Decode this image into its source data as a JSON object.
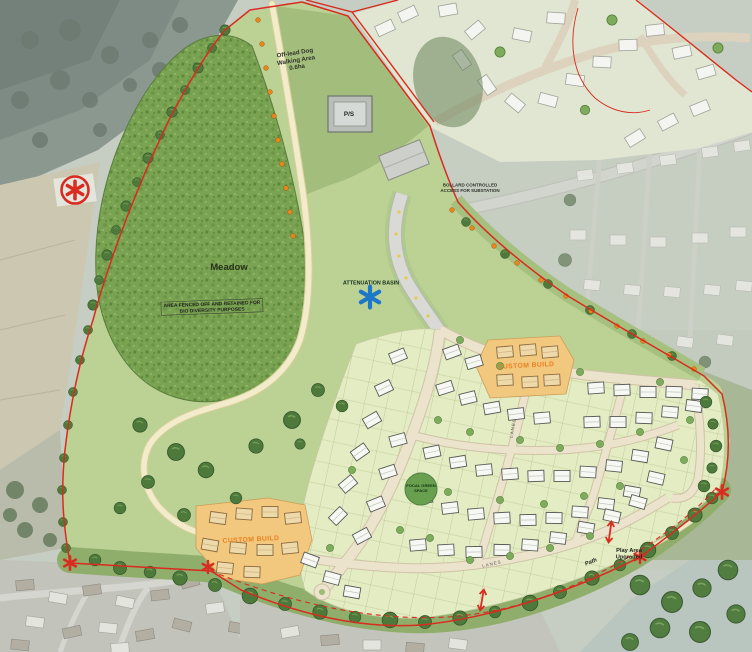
{
  "map": {
    "title": "Residential development masterplan",
    "labels": {
      "off_lead_dog": [
        "Off-lead Dog",
        "Walking Area",
        "0.6ha"
      ],
      "meadow": "Meadow",
      "biodiversity": [
        "AREA FENCED OFF AND RETAINED FOR",
        "BIO DIVERSITY PURPOSES"
      ],
      "attenuation": "ATTENUATION BASIN",
      "bollard": [
        "BOLLARD CONTROLLED",
        "ACCESS FOR SUBSTATION"
      ],
      "ps": "P/S",
      "custom_build_north": "CUSTOM BUILD",
      "custom_build_south": "CUSTOM BUILD",
      "focal": [
        "FOCAL GREEN",
        "SPACE"
      ],
      "play_area": [
        "Play Area",
        "Upgraded"
      ],
      "path": "Path",
      "lanes": "LANES"
    },
    "colors": {
      "boundary_red": "#d92b1f",
      "attenuation_blue": "#1d78c8",
      "custom_orange": "#e8821e",
      "orange_parcel": "#f2c77e",
      "meadow_green": "#79a251",
      "open_space_green": "#bcd194",
      "path_cream": "#f2ecca",
      "tree_green": "#4d7a3b"
    },
    "markers": {
      "site_corner": "red-asterisk",
      "attenuation_basin": "blue-asterisk",
      "access_point": "red-double-arrow",
      "boundary_planting": "orange-dot"
    }
  }
}
